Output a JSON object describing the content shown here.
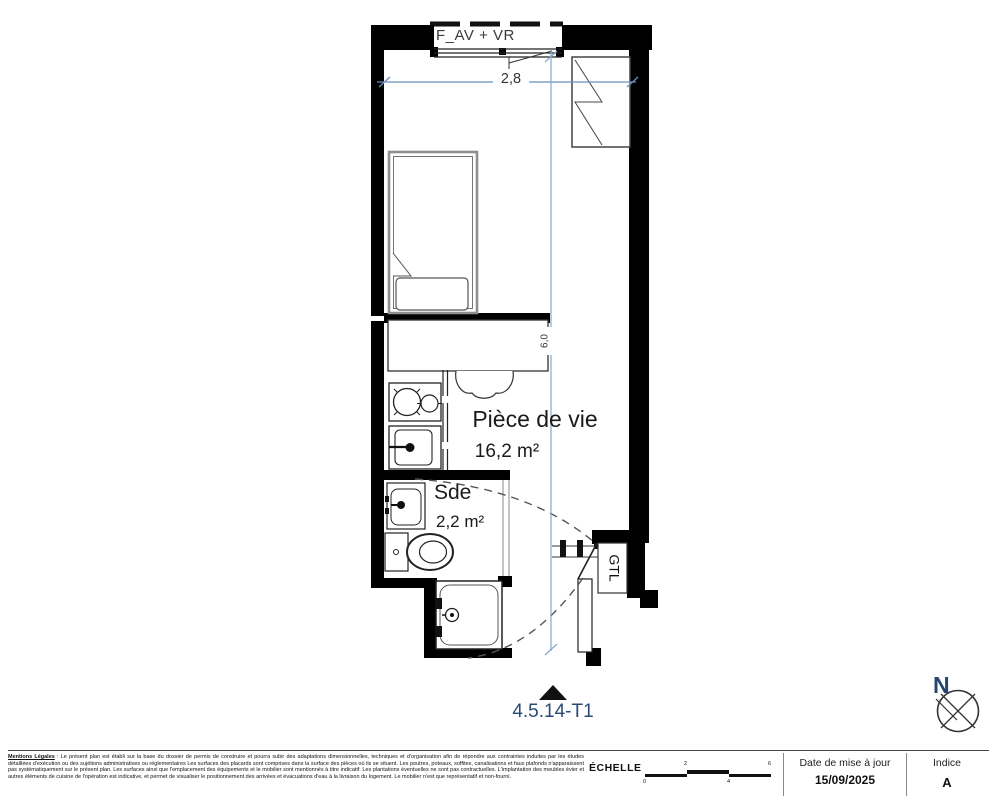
{
  "plan": {
    "window_label": "F_AV + VR",
    "dimensions": {
      "width_label": "2,8",
      "height_label": "6,0",
      "line_color": "#6c8ebf"
    },
    "rooms": {
      "living": {
        "name": "Pièce de vie",
        "area": "16,2 m²"
      },
      "bathroom": {
        "name": "Sde",
        "area": "2,2 m²"
      }
    },
    "gtl_label": "GTL",
    "unit_label": "4.5.14-T1"
  },
  "compass": {
    "label": "N"
  },
  "footer": {
    "legal": {
      "title": "Mentions Légales",
      "body": " : Le présent plan est établi sur la base du dossier de permis de construire et pourra subir des adaptations dimensionnelles, techniques et d'organisation afin de répondre aux contraintes induites par les études détaillées d'exécution ou des sujétions administratives ou réglementaires Les surfaces des placards sont comprises dans la surface des pièces où ils se situent. Les poutres, poteaux, soffites, canalisations et faux plafonds n'apparaissent pas systématiquement sur le présent plan. Les surfaces ainsi que l'emplacement des équipements et le mobilier sont mentionnés à titre indicatif. Les plantations éventuelles ne sont pas contractuelles. L'implantation des meubles évier et autres éléments de cuisine de l'opération est indicative, et permet de visualiser le positionnement des arrivées et évacuations d'eau à la livraison du logement. Le mobilier n'est que représentatif et non-fourni."
    },
    "scale": {
      "label": "ÉCHELLE",
      "ticks_top": [
        "2",
        "6"
      ],
      "ticks_bottom": [
        "0",
        "4"
      ]
    },
    "date": {
      "label": "Date de mise à jour",
      "value": "15/09/2025"
    },
    "index": {
      "label": "Indice",
      "value": "A"
    }
  },
  "colors": {
    "wall": "#000000",
    "dimension_blue": "#6c8ebf",
    "unit_label_navy": "#2b4a73"
  }
}
